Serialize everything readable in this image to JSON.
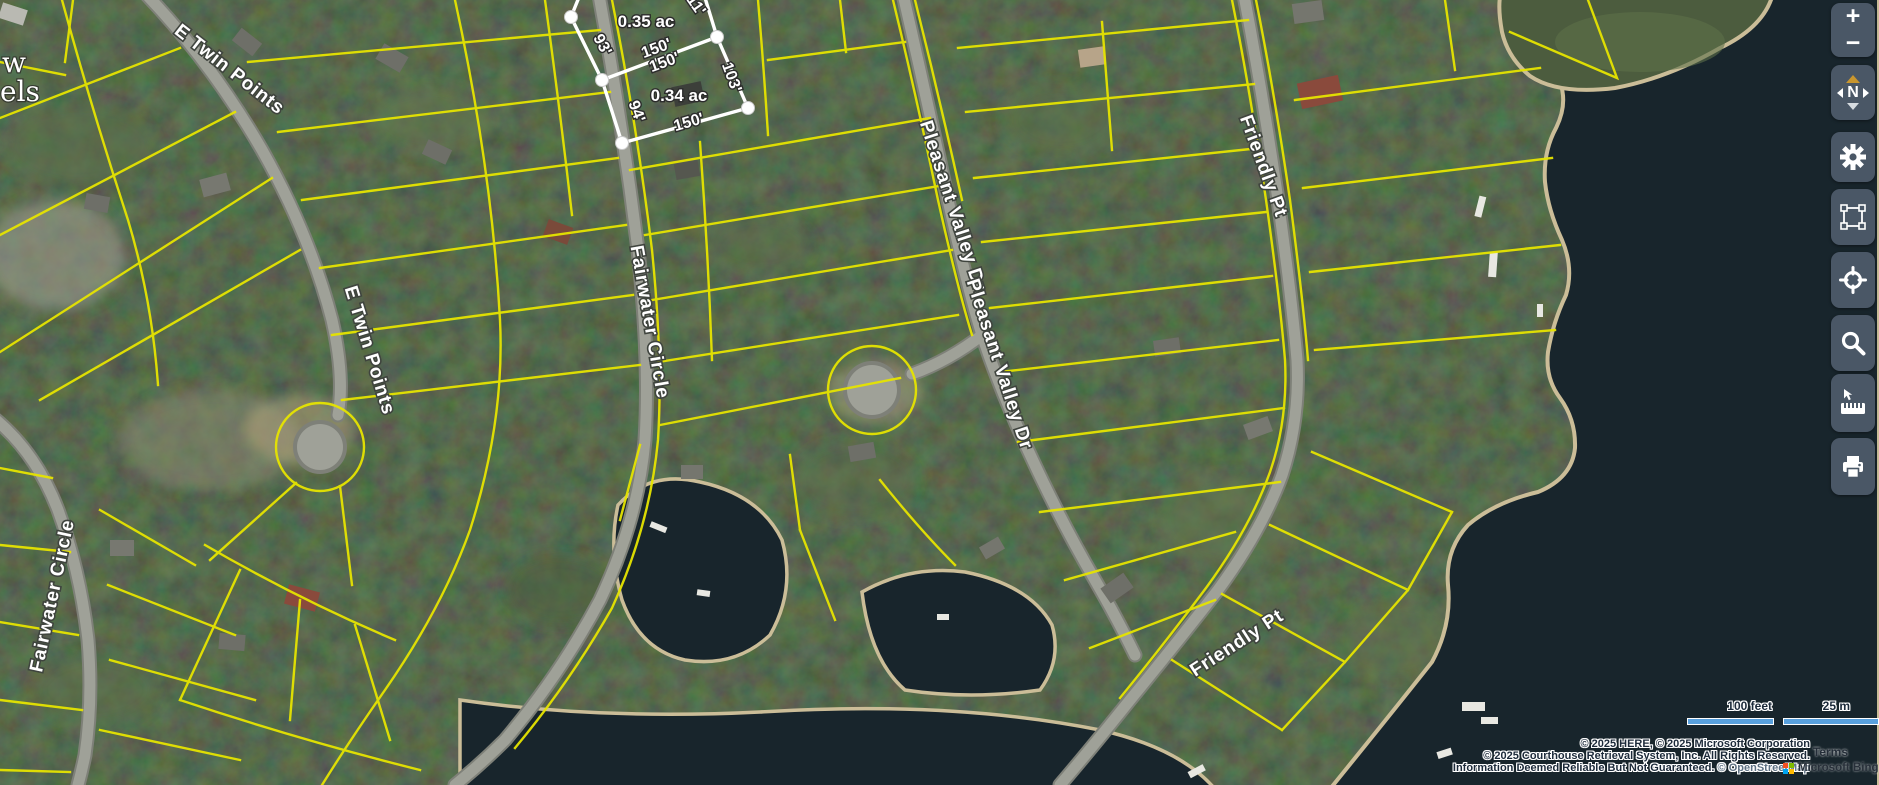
{
  "map": {
    "street_labels": [
      {
        "text": "E Twin Points",
        "x": 226,
        "y": 74,
        "rotate": 38,
        "size": 19
      },
      {
        "text": "E Twin Points",
        "x": 364,
        "y": 352,
        "rotate": 73,
        "size": 19
      },
      {
        "text": "Fairwater Circle",
        "x": 644,
        "y": 323,
        "rotate": 80,
        "size": 19
      },
      {
        "text": "Fairwater Circle",
        "x": 58,
        "y": 597,
        "rotate": -78,
        "size": 19
      },
      {
        "text": "Pleasant Valley Dr.",
        "x": 948,
        "y": 210,
        "rotate": 72,
        "size": 19
      },
      {
        "text": "Pleasant Valley Dr",
        "x": 994,
        "y": 366,
        "rotate": 72,
        "size": 19
      },
      {
        "text": "Friendly Pt",
        "x": 1258,
        "y": 168,
        "rotate": 70,
        "size": 19
      },
      {
        "text": "Friendly Pt",
        "x": 1240,
        "y": 648,
        "rotate": -33,
        "size": 19
      }
    ],
    "corner_fragments": [
      {
        "text": "w",
        "x": 2,
        "y": 72,
        "rotate": 0,
        "size": 28
      },
      {
        "text": "els",
        "x": 0,
        "y": 101,
        "rotate": 0,
        "size": 28
      }
    ],
    "parcel_dimensions": [
      {
        "text": "0.35 ac",
        "x": 646,
        "y": 27,
        "rotate": 0,
        "size": 17
      },
      {
        "text": "93'",
        "x": 598,
        "y": 47,
        "rotate": 62,
        "size": 16
      },
      {
        "text": "150'",
        "x": 658,
        "y": 53,
        "rotate": -20,
        "size": 16
      },
      {
        "text": "150'",
        "x": 666,
        "y": 67,
        "rotate": -20,
        "size": 16
      },
      {
        "text": "0.34 ac",
        "x": 679,
        "y": 101,
        "rotate": 0,
        "size": 17
      },
      {
        "text": "103'",
        "x": 727,
        "y": 79,
        "rotate": 70,
        "size": 16
      },
      {
        "text": "94'",
        "x": 632,
        "y": 113,
        "rotate": 70,
        "size": 16
      },
      {
        "text": "150'",
        "x": 690,
        "y": 127,
        "rotate": -16,
        "size": 16
      },
      {
        "text": "11'",
        "x": 692,
        "y": 8,
        "rotate": 55,
        "size": 16
      }
    ]
  },
  "controls": {
    "zoom_in_label": "+",
    "zoom_out_label": "−",
    "compass_north_label": "N",
    "buttons": [
      {
        "name": "settings",
        "icon": "gear-icon"
      },
      {
        "name": "select-area",
        "icon": "marquee-icon"
      },
      {
        "name": "locate",
        "icon": "crosshair-icon"
      },
      {
        "name": "search",
        "icon": "search-icon"
      },
      {
        "name": "measure",
        "icon": "ruler-icon"
      },
      {
        "name": "print",
        "icon": "printer-icon"
      }
    ]
  },
  "scalebar": {
    "feet": "100 feet",
    "meters": "25 m"
  },
  "attribution": {
    "line1": "© 2025 HERE, © 2025 Microsoft Corporation",
    "line2": "© 2025 Courthouse Retrieval System, Inc. All Rights Reserved.",
    "line3": "Information Deemed Reliable But Not Guaranteed.",
    "osm": "© OpenStreetMap",
    "terms": "Terms",
    "bing": "Microsoft Bing"
  },
  "colors": {
    "parcel_line": "#e6e400",
    "highlight_outline": "#ffffff",
    "water": "#18252c",
    "scalebar_fill": "#58a0dd",
    "sidebar_button": "#4a5766",
    "compass_needle": "#c9962e"
  }
}
